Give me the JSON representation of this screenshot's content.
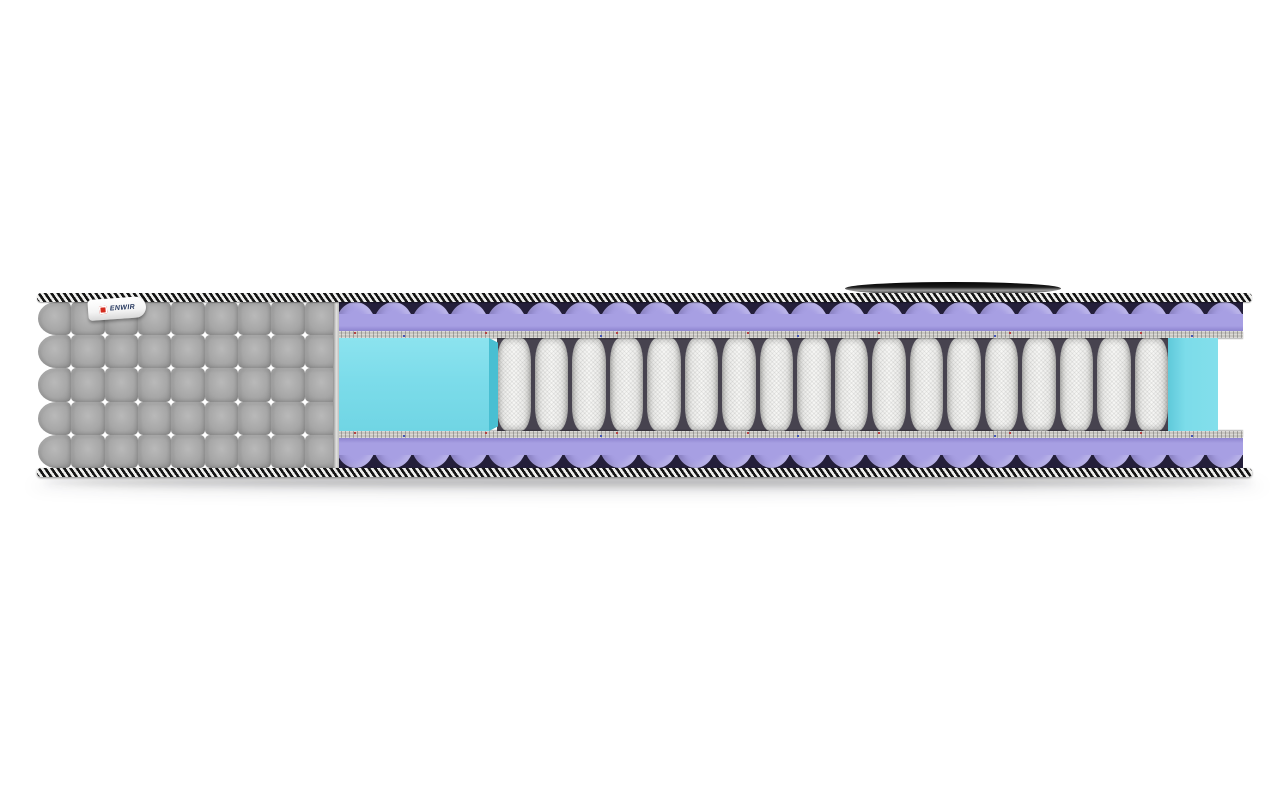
{
  "scene": {
    "title": "Mattress cross-section product render",
    "brand_tag": {
      "label": "ENWIR",
      "icon": "red-square-logo"
    },
    "quilt": {
      "rows": 5,
      "cols": 9,
      "cells": 45
    },
    "waves": {
      "top": 24,
      "bottom": 24
    },
    "springs": {
      "count": 18
    },
    "layers": [
      {
        "name": "quilted-fabric-cover",
        "color_key": "cover"
      },
      {
        "name": "edge-tape-top",
        "style": "black-white-diagonal-stripes"
      },
      {
        "name": "egg-crate-foam-top",
        "color_key": "purple"
      },
      {
        "name": "felt-pad-top",
        "color_key": "felt"
      },
      {
        "name": "perimeter-foam-box-left",
        "color_key": "cyan"
      },
      {
        "name": "pocket-spring-block",
        "color_key": "spring-face"
      },
      {
        "name": "perimeter-foam-box-right",
        "color_key": "cyan"
      },
      {
        "name": "felt-pad-bottom",
        "color_key": "felt"
      },
      {
        "name": "egg-crate-foam-bottom",
        "color_key": "purple"
      },
      {
        "name": "edge-tape-bottom",
        "style": "black-white-diagonal-stripes"
      }
    ],
    "handle": {
      "name": "carry-handle",
      "color_key": "handle"
    }
  },
  "colors": {
    "cover": "#a7a7a7",
    "cover-hi": "#b9b9b9",
    "cover-lo": "#8e8e8e",
    "tape-dark": "#141414",
    "tape-light": "#f0f0ee",
    "purple": "#a79fe3",
    "purple-dark": "#8d84cf",
    "valley-dark": "#241f3a",
    "felt": "#c7c5c0",
    "cyan": "#7cdcea",
    "cyan-side": "#49bfd2",
    "spring-face": "#f7f7f5",
    "spring-edge": "#c7c7c4",
    "spring-gap": "#47434f",
    "handle": "#1a1a1a",
    "tag-text": "#23355c",
    "logo-red": "#d42b1e"
  }
}
